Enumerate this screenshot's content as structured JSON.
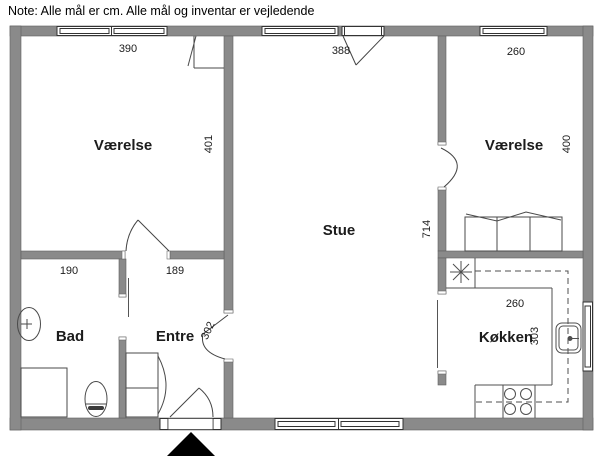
{
  "note": "Note: Alle mål er cm. Alle mål og inventar er vejledende",
  "rooms": {
    "vaerelse_left": {
      "name": "Værelse",
      "width": "390",
      "depth": "401"
    },
    "stue": {
      "name": "Stue",
      "width": "388",
      "depth": "714"
    },
    "vaerelse_right": {
      "name": "Værelse",
      "width": "260",
      "depth": "400"
    },
    "bad": {
      "name": "Bad",
      "width": "190"
    },
    "entre": {
      "name": "Entre",
      "width": "189",
      "door_opening": "302"
    },
    "koekken": {
      "name": "Køkken",
      "width": "260",
      "depth": "303"
    }
  },
  "units": "cm",
  "colors": {
    "wall": "#8a8a8a",
    "line": "#3d3d3d",
    "background": "#ffffff",
    "entrance_marker": "#000000"
  }
}
